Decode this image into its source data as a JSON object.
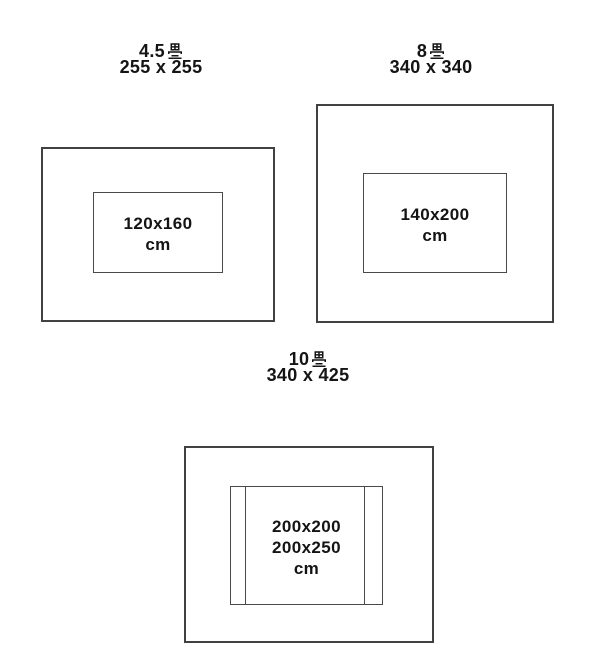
{
  "page": {
    "background_color": "#ffffff",
    "line_color": "#414141",
    "text_color": "#141414"
  },
  "diagrams": [
    {
      "id": "room-4-5-tatami",
      "tatami_count": "4.5",
      "unit": "畳",
      "room_label": "4.5畳",
      "room_size": "255 x 255",
      "rug_lines": [
        "120x160",
        "cm"
      ],
      "rug_size": "120x160 cm"
    },
    {
      "id": "room-8-tatami",
      "tatami_count": "8",
      "unit": "畳",
      "room_label": "8畳",
      "room_size": "340 x 340",
      "rug_lines": [
        "140x200",
        "cm"
      ],
      "rug_size": "140x200 cm"
    },
    {
      "id": "room-10-tatami",
      "tatami_count": "10",
      "unit": "畳",
      "room_label": "10畳",
      "room_size": "340 x 425",
      "rug_lines": [
        "200x200",
        "200x250",
        "cm"
      ],
      "rug_size": "200x200 / 200x250 cm"
    }
  ]
}
